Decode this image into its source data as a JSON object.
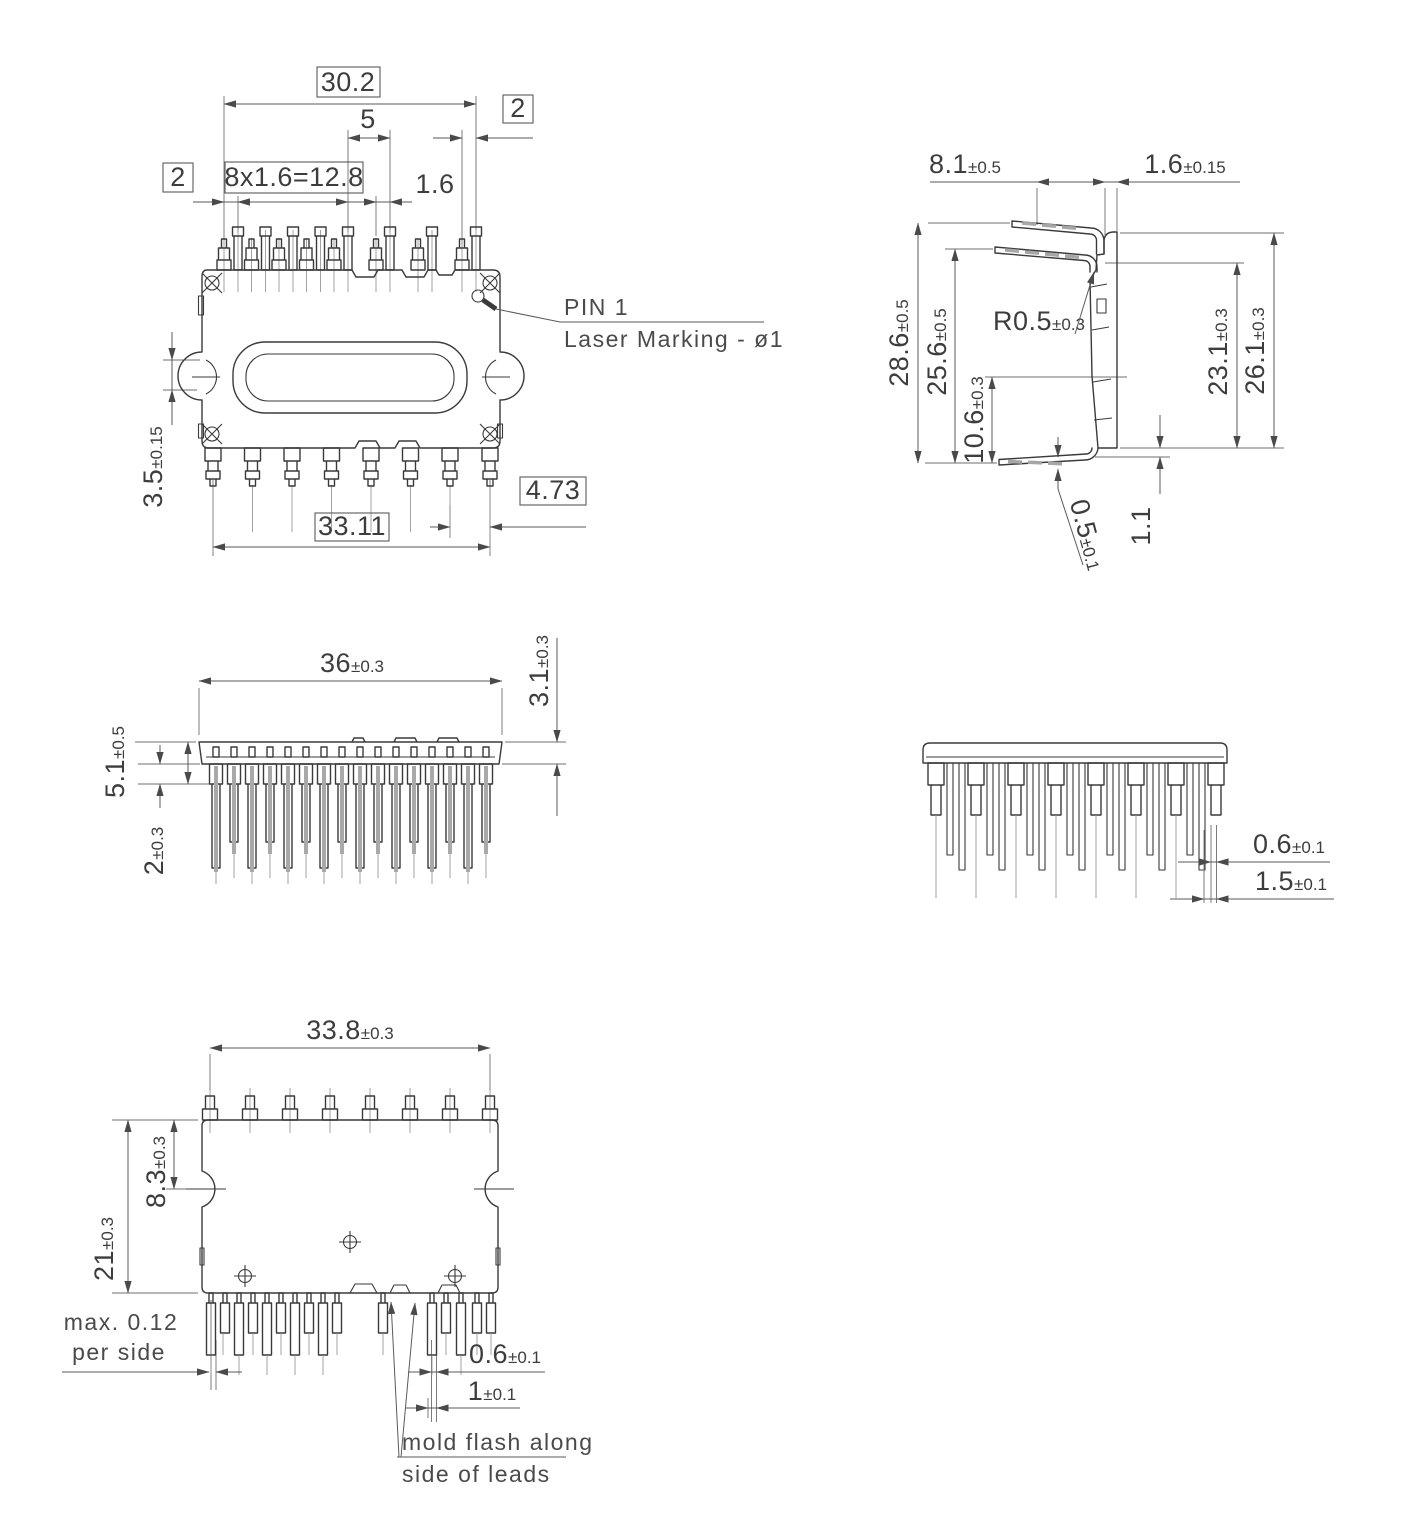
{
  "colors": {
    "line": "#3a3a3a",
    "dim": "#5a5a5a",
    "text": "#3d3d3d",
    "background": "#ffffff"
  },
  "top": {
    "d30_2": {
      "value": "30.2"
    },
    "d5": {
      "value": "5"
    },
    "d2_right": {
      "value": "2"
    },
    "d2_left": {
      "value": "2"
    },
    "dpitch": {
      "value": "8x1.6=12.8"
    },
    "d1_6": {
      "value": "1.6"
    },
    "d3_5": {
      "value": "3.5",
      "tol": "±0.15"
    },
    "d33_11": {
      "value": "33.11"
    },
    "d4_73": {
      "value": "4.73"
    },
    "pin1": "PIN 1",
    "laser": "Laser Marking - ø1"
  },
  "side": {
    "d8_1": {
      "value": "8.1",
      "tol": "±0.5"
    },
    "d1_6": {
      "value": "1.6",
      "tol": "±0.15"
    },
    "d28_6": {
      "value": "28.6",
      "tol": "±0.5"
    },
    "d25_6": {
      "value": "25.6",
      "tol": "±0.5"
    },
    "dR0_5": {
      "value": "R0.5",
      "tol": "±0.3"
    },
    "d23_1": {
      "value": "23.1",
      "tol": "±0.3"
    },
    "d26_1": {
      "value": "26.1",
      "tol": "±0.3"
    },
    "d10_6": {
      "value": "10.6",
      "tol": "±0.3"
    },
    "d0_5": {
      "value": "0.5",
      "tol": "±0.1"
    },
    "d1_1": {
      "value": "1.1"
    }
  },
  "front": {
    "d36": {
      "value": "36",
      "tol": "±0.3"
    },
    "d3_1": {
      "value": "3.1",
      "tol": "±0.3"
    },
    "d5_1": {
      "value": "5.1",
      "tol": "±0.5"
    },
    "d2": {
      "value": "2",
      "tol": "±0.3"
    }
  },
  "back": {
    "d0_6": {
      "value": "0.6",
      "tol": "±0.1"
    },
    "d1_5": {
      "value": "1.5",
      "tol": "±0.1"
    }
  },
  "bottom": {
    "d33_8": {
      "value": "33.8",
      "tol": "±0.3"
    },
    "d21": {
      "value": "21",
      "tol": "±0.3"
    },
    "d8_3": {
      "value": "8.3",
      "tol": "±0.3"
    },
    "max_flash": {
      "line1": "max. 0.12",
      "line2": "per side"
    },
    "d0_6": {
      "value": "0.6",
      "tol": "±0.1"
    },
    "d1": {
      "value": "1",
      "tol": "±0.1"
    },
    "mold_flash": {
      "line1": "mold flash along",
      "line2": "side of leads"
    }
  }
}
